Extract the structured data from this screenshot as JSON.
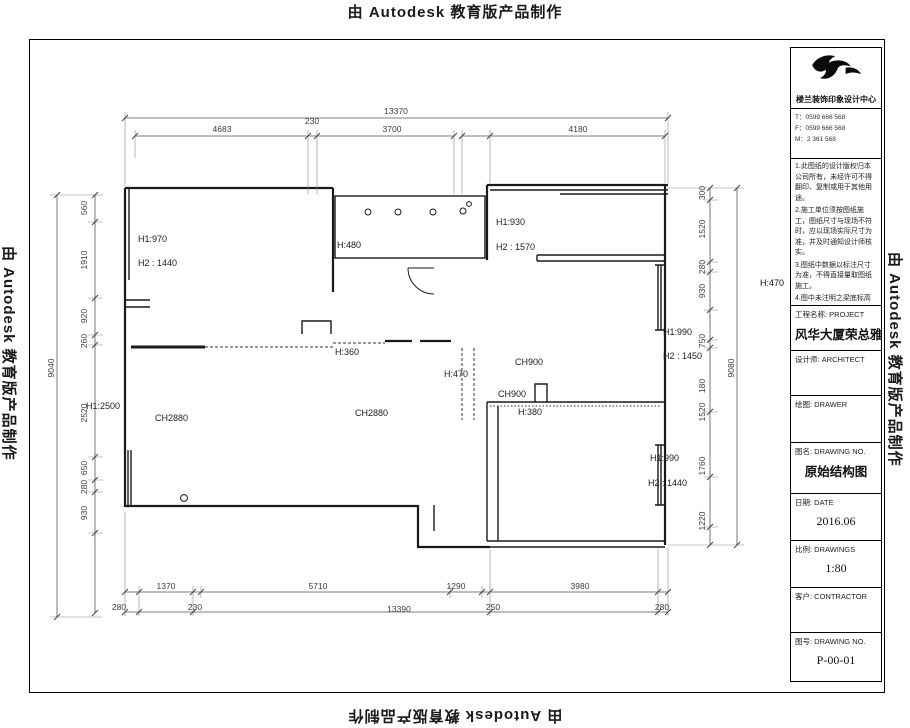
{
  "watermark": "由 Autodesk 教育版产品制作",
  "dims": {
    "top_overall": "13370",
    "top_segments": [
      "4683",
      "230",
      "3700",
      "4180"
    ],
    "bottom_segments": [
      "1370",
      "5710",
      "1290",
      "3980"
    ],
    "bottom_row2": [
      "280",
      "230",
      "13390",
      "250",
      "280"
    ],
    "left_overall": "9040",
    "left_segments": [
      "560",
      "1910",
      "920",
      "260",
      "2520",
      "650",
      "280",
      "930"
    ],
    "right_overall": "9080",
    "right_segments": [
      "300",
      "1520",
      "280",
      "930",
      "750",
      "180",
      "1520",
      "1760",
      "1220"
    ]
  },
  "plan_labels": {
    "tl1": "H1:970",
    "tl2": "H2 : 1440",
    "mid_top": "H:480",
    "tr1": "H1:930",
    "tr2": "H2 : 1570",
    "h360": "H:360",
    "h470": "H:470",
    "ch900a": "CH900",
    "ch900b": "CH900",
    "h380": "H:380",
    "ch2880a": "CH2880",
    "ch2880b": "CH2880",
    "h2500": "H1:2500",
    "rm1": "H1:990",
    "rm2": "H2 : 1450",
    "br1": "H1:990",
    "br2": "H2 : 1440",
    "note_h": "H:470"
  },
  "title_block": {
    "company": "楼兰装饰印象设计中心",
    "contact_lines": [
      "T：0599 666 568",
      "F：0599 666 568",
      "M：2 361 568"
    ],
    "notes": [
      "1.此图纸的设计版权归本公司所有，未经许可不得翻印、复制或用于其他用途。",
      "2.施工单位须按图纸施工，图纸尺寸与现场不符时，应以现场实际尺寸为准，并及时通知设计师核实。",
      "3.图纸中数据以标注尺寸为准，不得直接量取图纸施工。",
      "4.图中未注明之梁底标高均为 H:470，施工前请以现场实测为准。"
    ],
    "project_label": "工程名称: PROJECT",
    "project_name": "风华大厦荣总雅居",
    "architect_label": "设计师:  ARCHITECT",
    "drawer_label": "绘图: DRAWER",
    "drawing_name_label": "图名: DRAWING NO.",
    "drawing_name": "原始结构图",
    "date_label": "日期: DATE",
    "date_value": "2016.06",
    "scale_label": "比例: DRAWINGS",
    "scale_value": "1:80",
    "client_label": "客户: CONTRACTOR",
    "no_label": "图号: DRAWING NO.",
    "no_value": "P-00-01"
  }
}
